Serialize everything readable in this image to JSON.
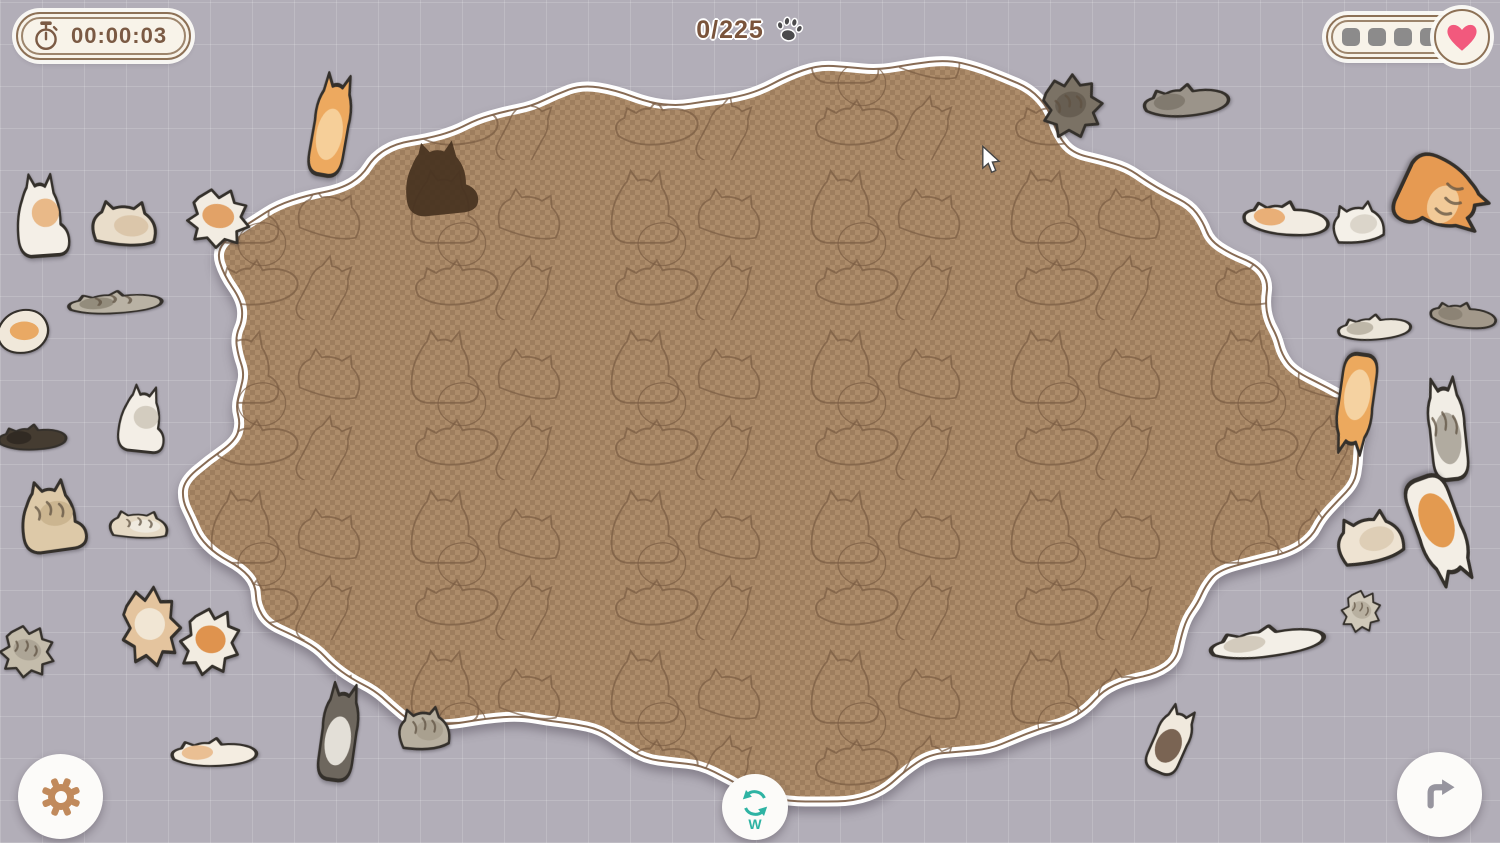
{
  "hud": {
    "timer": {
      "label": "00:00:03",
      "icon": "stopwatch-icon"
    },
    "progress": {
      "label": "0/225",
      "icon": "paw-icon"
    },
    "lives": {
      "empty_slots": 4,
      "icon": "heart-icon"
    }
  },
  "controls": {
    "settings": {
      "icon": "gear-icon"
    },
    "redo": {
      "icon": "redo-arrow-icon"
    },
    "rotate": {
      "icon": "rotate-icon",
      "key_label": "W"
    }
  },
  "colors": {
    "background": "#b2aeb8",
    "pill_bg": "#f8f3e9",
    "pill_border": "#8d7156",
    "hud_text": "#7b5a44",
    "heart": "#f2597d",
    "life_slot": "#8c8b8b",
    "gear": "#c18a5c",
    "redo_arrow": "#97959f",
    "teal": "#2eb3a3",
    "checker_light": "#ad8c6a",
    "checker_dark": "#9e7e5e",
    "blob_line": "#7a5b41",
    "blob_border": "#ffffff",
    "silhouette": "#463220",
    "piece_outline": "#34302b"
  },
  "board": {
    "cx": 758,
    "cy": 424,
    "rx": 562,
    "ry": 352,
    "pieces_total": 225,
    "pieces_placed": 0
  },
  "placed_silhouette": {
    "x": 392,
    "y": 130,
    "w": 96,
    "h": 92,
    "rot": -6
  },
  "cursor": {
    "x": 980,
    "y": 145
  },
  "tray_pieces": [
    {
      "name": "white-sitting-cat",
      "variant": "sitting",
      "x": 8,
      "y": 162,
      "w": 68,
      "h": 102,
      "rot": -4,
      "body": "#f4efe7",
      "patch": "#e8b27d",
      "stripes": false
    },
    {
      "name": "cream-loaf-cat",
      "variant": "loaf",
      "x": 84,
      "y": 183,
      "w": 86,
      "h": 82,
      "rot": 3,
      "body": "#e9ddca",
      "patch": "#d9c3a6",
      "stripes": false
    },
    {
      "name": "white-orange-crumpled",
      "variant": "crumpled",
      "x": 178,
      "y": 180,
      "w": 80,
      "h": 75,
      "rot": 10,
      "body": "#f2ece2",
      "patch": "#e09a5a",
      "stripes": false
    },
    {
      "name": "gray-stretched-cat",
      "variant": "lying",
      "x": 62,
      "y": 278,
      "w": 108,
      "h": 48,
      "rot": -4,
      "body": "#b9b2a4",
      "patch": "#8f8778",
      "stripes": true
    },
    {
      "name": "orange-white-edge-cat",
      "variant": "curled",
      "x": -10,
      "y": 303,
      "w": 66,
      "h": 58,
      "rot": 0,
      "body": "#f0e8da",
      "patch": "#e8a257",
      "stripes": false
    },
    {
      "name": "dark-lying-cat",
      "variant": "lying",
      "x": -6,
      "y": 410,
      "w": 78,
      "h": 54,
      "rot": -3,
      "body": "#453c31",
      "patch": "#2f2822",
      "stripes": false
    },
    {
      "name": "white-gray-cat",
      "variant": "sitting",
      "x": 112,
      "y": 376,
      "w": 62,
      "h": 82,
      "rot": 6,
      "body": "#f3eee6",
      "patch": "#cfc8ba",
      "stripes": false
    },
    {
      "name": "tan-walking-cat",
      "variant": "sitting",
      "x": 10,
      "y": 470,
      "w": 84,
      "h": 88,
      "rot": -8,
      "body": "#ddc9a8",
      "patch": "#c9b28d",
      "stripes": true
    },
    {
      "name": "tabby-loaf-cat",
      "variant": "loaf",
      "x": 102,
      "y": 500,
      "w": 78,
      "h": 50,
      "rot": 2,
      "body": "#e5d9c4",
      "patch": "#f0ebe2",
      "stripes": true
    },
    {
      "name": "gray-tabby-piece",
      "variant": "crumpled",
      "x": -8,
      "y": 618,
      "w": 70,
      "h": 66,
      "rot": 14,
      "body": "#c4bcab",
      "patch": "#aba293",
      "stripes": true
    },
    {
      "name": "tan-crumpled-piece",
      "variant": "crumpled",
      "x": 112,
      "y": 576,
      "w": 76,
      "h": 100,
      "rot": -6,
      "body": "#e4c49e",
      "patch": "#f2ead9",
      "stripes": false
    },
    {
      "name": "white-orange-crumpled-2",
      "variant": "crumpled",
      "x": 172,
      "y": 598,
      "w": 76,
      "h": 86,
      "rot": 18,
      "body": "#f2ece1",
      "patch": "#dd8a3e",
      "stripes": false
    },
    {
      "name": "cream-sleeping-cat",
      "variant": "lying",
      "x": 166,
      "y": 722,
      "w": 98,
      "h": 60,
      "rot": -2,
      "body": "#f4ede1",
      "patch": "#e9b98b",
      "stripes": false
    },
    {
      "name": "gray-standing-cat",
      "variant": "standing",
      "x": 303,
      "y": 676,
      "w": 72,
      "h": 112,
      "rot": 8,
      "body": "#6e675e",
      "patch": "#f0ece4",
      "stripes": false
    },
    {
      "name": "gray-tabby-sitting",
      "variant": "loaf",
      "x": 392,
      "y": 690,
      "w": 68,
      "h": 78,
      "rot": -4,
      "body": "#b7af9f",
      "patch": "#a79e8d",
      "stripes": true
    },
    {
      "name": "orange-cat-on-edge",
      "variant": "standing",
      "x": 295,
      "y": 66,
      "w": 72,
      "h": 118,
      "rot": 10,
      "body": "#eda95f",
      "patch": "#f6d3a0",
      "stripes": false
    },
    {
      "name": "dark-tabby-piece",
      "variant": "crumpled",
      "x": 1032,
      "y": 66,
      "w": 78,
      "h": 80,
      "rot": -12,
      "body": "#7b7265",
      "patch": "#655c50",
      "stripes": true
    },
    {
      "name": "gray-cat-topright",
      "variant": "lying",
      "x": 1138,
      "y": 66,
      "w": 98,
      "h": 68,
      "rot": -6,
      "body": "#9b948a",
      "patch": "#7e776c",
      "stripes": false
    },
    {
      "name": "white-orange-curled",
      "variant": "lying",
      "x": 1238,
      "y": 182,
      "w": 98,
      "h": 72,
      "rot": 4,
      "body": "#f2ece2",
      "patch": "#e8a86b",
      "stripes": false
    },
    {
      "name": "white-cat-right",
      "variant": "loaf",
      "x": 1326,
      "y": 186,
      "w": 68,
      "h": 74,
      "rot": -8,
      "body": "#f4f0e8",
      "patch": "#d8d2c6",
      "stripes": false
    },
    {
      "name": "orange-tabby-flying",
      "variant": "sitting",
      "x": 1396,
      "y": 146,
      "w": 98,
      "h": 108,
      "rot": 115,
      "body": "#e69a52",
      "patch": "#f3cfa0",
      "stripes": true
    },
    {
      "name": "gray-white-piece-right",
      "variant": "lying",
      "x": 1333,
      "y": 300,
      "w": 84,
      "h": 54,
      "rot": -5,
      "body": "#ece6da",
      "patch": "#b9b1a2",
      "stripes": false
    },
    {
      "name": "gray-brown-cat-right",
      "variant": "lying",
      "x": 1426,
      "y": 288,
      "w": 76,
      "h": 54,
      "rot": 6,
      "body": "#a2988a",
      "patch": "#8a8172",
      "stripes": false
    },
    {
      "name": "orange-hanging-cat",
      "variant": "standing",
      "x": 1320,
      "y": 346,
      "w": 72,
      "h": 116,
      "rot": 188,
      "body": "#eca95e",
      "patch": "#f6d6a8",
      "stripes": false
    },
    {
      "name": "chubby-gray-white-cat",
      "variant": "standing",
      "x": 1410,
      "y": 370,
      "w": 74,
      "h": 118,
      "rot": -6,
      "body": "#f1ede5",
      "patch": "#aaa398",
      "stripes": true
    },
    {
      "name": "cream-cat-right",
      "variant": "loaf",
      "x": 1328,
      "y": 492,
      "w": 88,
      "h": 92,
      "rot": -14,
      "body": "#eee3d2",
      "patch": "#dccbb2",
      "stripes": false
    },
    {
      "name": "white-orange-hanging",
      "variant": "standing",
      "x": 1394,
      "y": 466,
      "w": 92,
      "h": 128,
      "rot": 160,
      "body": "#f3eee5",
      "patch": "#e1903f",
      "stripes": false
    },
    {
      "name": "small-gray-tabby-right",
      "variant": "crumpled",
      "x": 1336,
      "y": 584,
      "w": 50,
      "h": 54,
      "rot": 20,
      "body": "#cfc8b9",
      "patch": "#b5ad9d",
      "stripes": true
    },
    {
      "name": "white-banana-cat",
      "variant": "lying",
      "x": 1202,
      "y": 608,
      "w": 132,
      "h": 66,
      "rot": -8,
      "body": "#f3efe7",
      "patch": "#cfc7b8",
      "stripes": false
    },
    {
      "name": "brown-white-small-cat",
      "variant": "standing",
      "x": 1136,
      "y": 700,
      "w": 70,
      "h": 80,
      "rot": 24,
      "body": "#f0e9dd",
      "patch": "#6d5544",
      "stripes": false
    }
  ]
}
